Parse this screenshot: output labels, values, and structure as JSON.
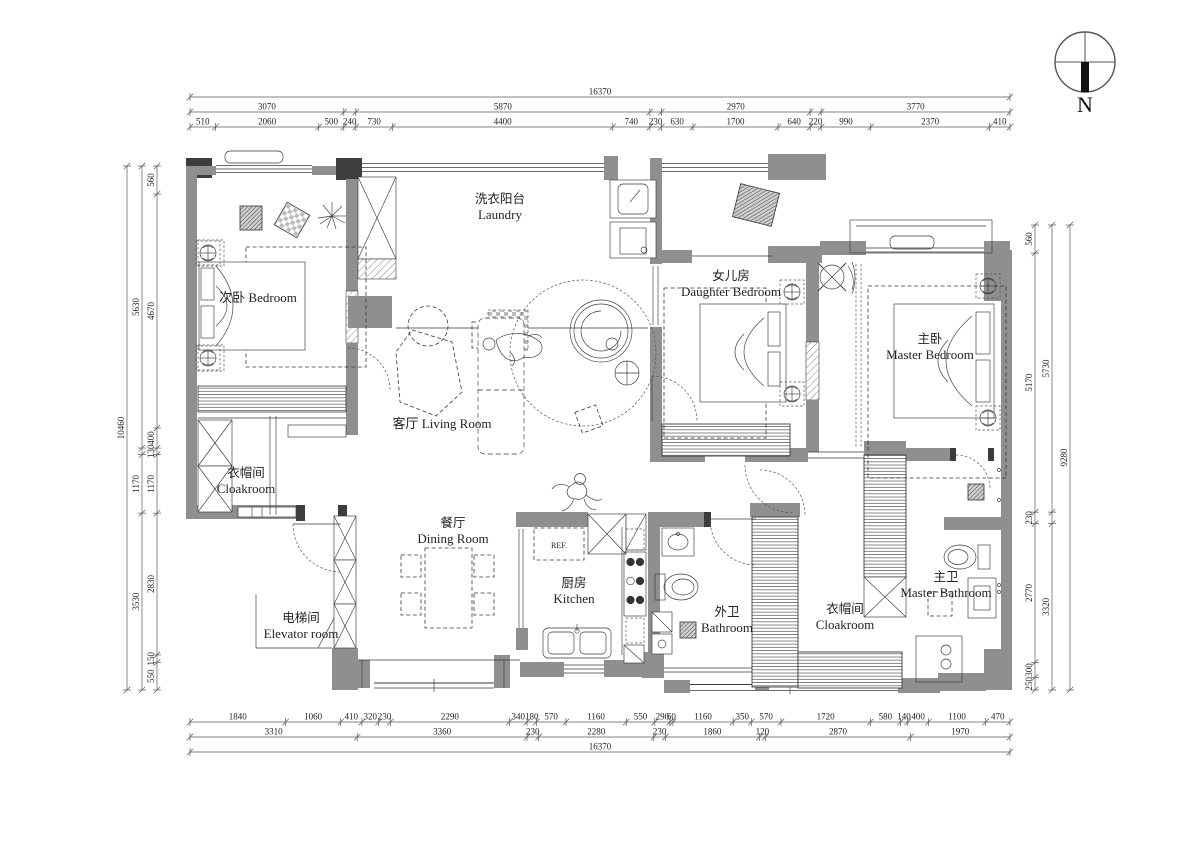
{
  "meta": {
    "type": "apartment-floor-plan",
    "units": "mm"
  },
  "north": {
    "label": "N"
  },
  "colors": {
    "wall": "#8f8f8f",
    "dark_wall": "#3d3d3d",
    "line": "#3a3a3a",
    "dim_text": "#222222"
  },
  "rooms": [
    {
      "id": "laundry",
      "lines": [
        "洗衣阳台",
        "Laundry"
      ],
      "x": 500,
      "y": 203
    },
    {
      "id": "bedroom-2",
      "lines": [
        "次卧 Bedroom"
      ],
      "x": 258,
      "y": 302
    },
    {
      "id": "living-room",
      "lines": [
        "客厅 Living Room"
      ],
      "x": 442,
      "y": 428
    },
    {
      "id": "daughter-bedroom",
      "lines": [
        "女儿房",
        "Daughter Bedroom"
      ],
      "x": 731,
      "y": 280
    },
    {
      "id": "master-bedroom",
      "lines": [
        "主卧",
        "Master Bedroom"
      ],
      "x": 930,
      "y": 343
    },
    {
      "id": "cloakroom-left",
      "lines": [
        "衣帽间",
        "Cloakroom"
      ],
      "x": 246,
      "y": 477
    },
    {
      "id": "elevator-room",
      "lines": [
        "电梯间",
        "Elevator room"
      ],
      "x": 301,
      "y": 622
    },
    {
      "id": "dining-room",
      "lines": [
        "餐厅",
        "Dining Room"
      ],
      "x": 453,
      "y": 527
    },
    {
      "id": "kitchen",
      "lines": [
        "厨房",
        "Kitchen"
      ],
      "x": 574,
      "y": 587
    },
    {
      "id": "bathroom",
      "lines": [
        "外卫",
        "Bathroom"
      ],
      "x": 727,
      "y": 616
    },
    {
      "id": "cloakroom-right",
      "lines": [
        "衣帽间",
        "Cloakroom"
      ],
      "x": 845,
      "y": 613
    },
    {
      "id": "master-bathroom",
      "lines": [
        "主卫",
        "Master Bathroom"
      ],
      "x": 946,
      "y": 581
    }
  ],
  "labels": {
    "fridge": "REF."
  },
  "dimensions": {
    "top": {
      "x1": 190,
      "x2": 1010,
      "rows": [
        {
          "y": 97,
          "segs": [
            "16370"
          ]
        },
        {
          "y": 112,
          "segs": [
            "3070",
            "|240",
            "5870",
            "|230",
            "2970",
            "|220",
            "3770"
          ]
        },
        {
          "y": 127,
          "segs": [
            "510",
            "2060",
            "500",
            "240",
            "730",
            "4400",
            "740",
            "230",
            "630",
            "1700",
            "640",
            "220",
            "990",
            "2370",
            "410"
          ]
        }
      ]
    },
    "bottom": {
      "x1": 190,
      "x2": 1010,
      "rows": [
        {
          "y": 722,
          "segs": [
            "1840",
            "1060",
            "410",
            "320",
            "230",
            "2290",
            "340",
            "180",
            "570",
            "1160",
            "550",
            "290",
            "60",
            "1160",
            "350",
            "570",
            "1720",
            "580",
            "140",
            "400",
            "1100",
            "470"
          ]
        },
        {
          "y": 737,
          "segs": [
            "3310",
            "3360",
            "230",
            "2280",
            "230",
            "1860",
            "120",
            "2870",
            "1970"
          ]
        },
        {
          "y": 752,
          "segs": [
            "16370"
          ]
        }
      ]
    },
    "left": {
      "y1": 166,
      "y2": 690,
      "cols": [
        {
          "x": 127,
          "segs": [
            "10460"
          ]
        },
        {
          "x": 142,
          "segs": [
            "5630",
            "|130",
            "1170",
            "3530"
          ]
        },
        {
          "x": 157,
          "segs": [
            "560",
            "4670",
            "400",
            "130",
            "1170",
            "2830",
            "150",
            "550"
          ]
        }
      ]
    },
    "right": {
      "y1": 225,
      "y2": 690,
      "cols": [
        {
          "x": 1035,
          "segs": [
            "560",
            "5170",
            "230",
            "2770",
            "300",
            "250"
          ]
        },
        {
          "x": 1052,
          "segs": [
            "5730",
            "|230",
            "3320"
          ]
        },
        {
          "x": 1070,
          "segs": [
            "9280"
          ]
        }
      ]
    }
  }
}
